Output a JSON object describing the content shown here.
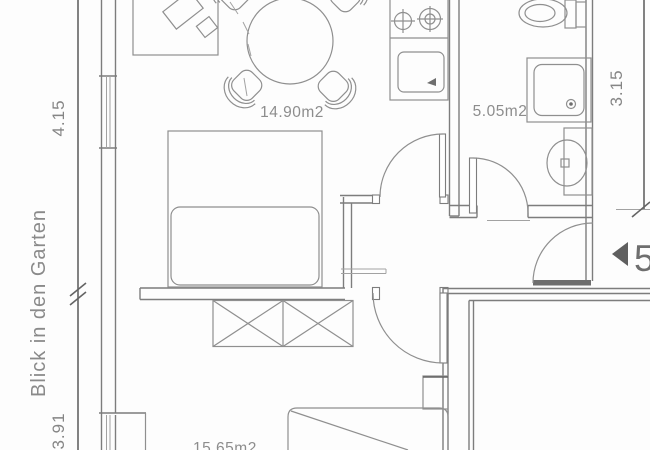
{
  "plan": {
    "rooms": {
      "living_room": {
        "area_label": "14.90m2"
      },
      "bathroom": {
        "area_label": "5.05m2"
      },
      "bedroom": {
        "area_label": "15.65m2"
      }
    },
    "dimensions": {
      "left_upper": "4.15",
      "left_lower": "3.91",
      "right": "3.15"
    },
    "annotations": {
      "garden_view": "Blick in den Garten",
      "entrance_number": "5"
    },
    "colors": {
      "wall_line": "#7d7d7d",
      "furniture_line": "#8f8f8f",
      "dark_line": "#646464",
      "label_text": "#8d8d8d",
      "background": "#fdfdfd"
    }
  }
}
